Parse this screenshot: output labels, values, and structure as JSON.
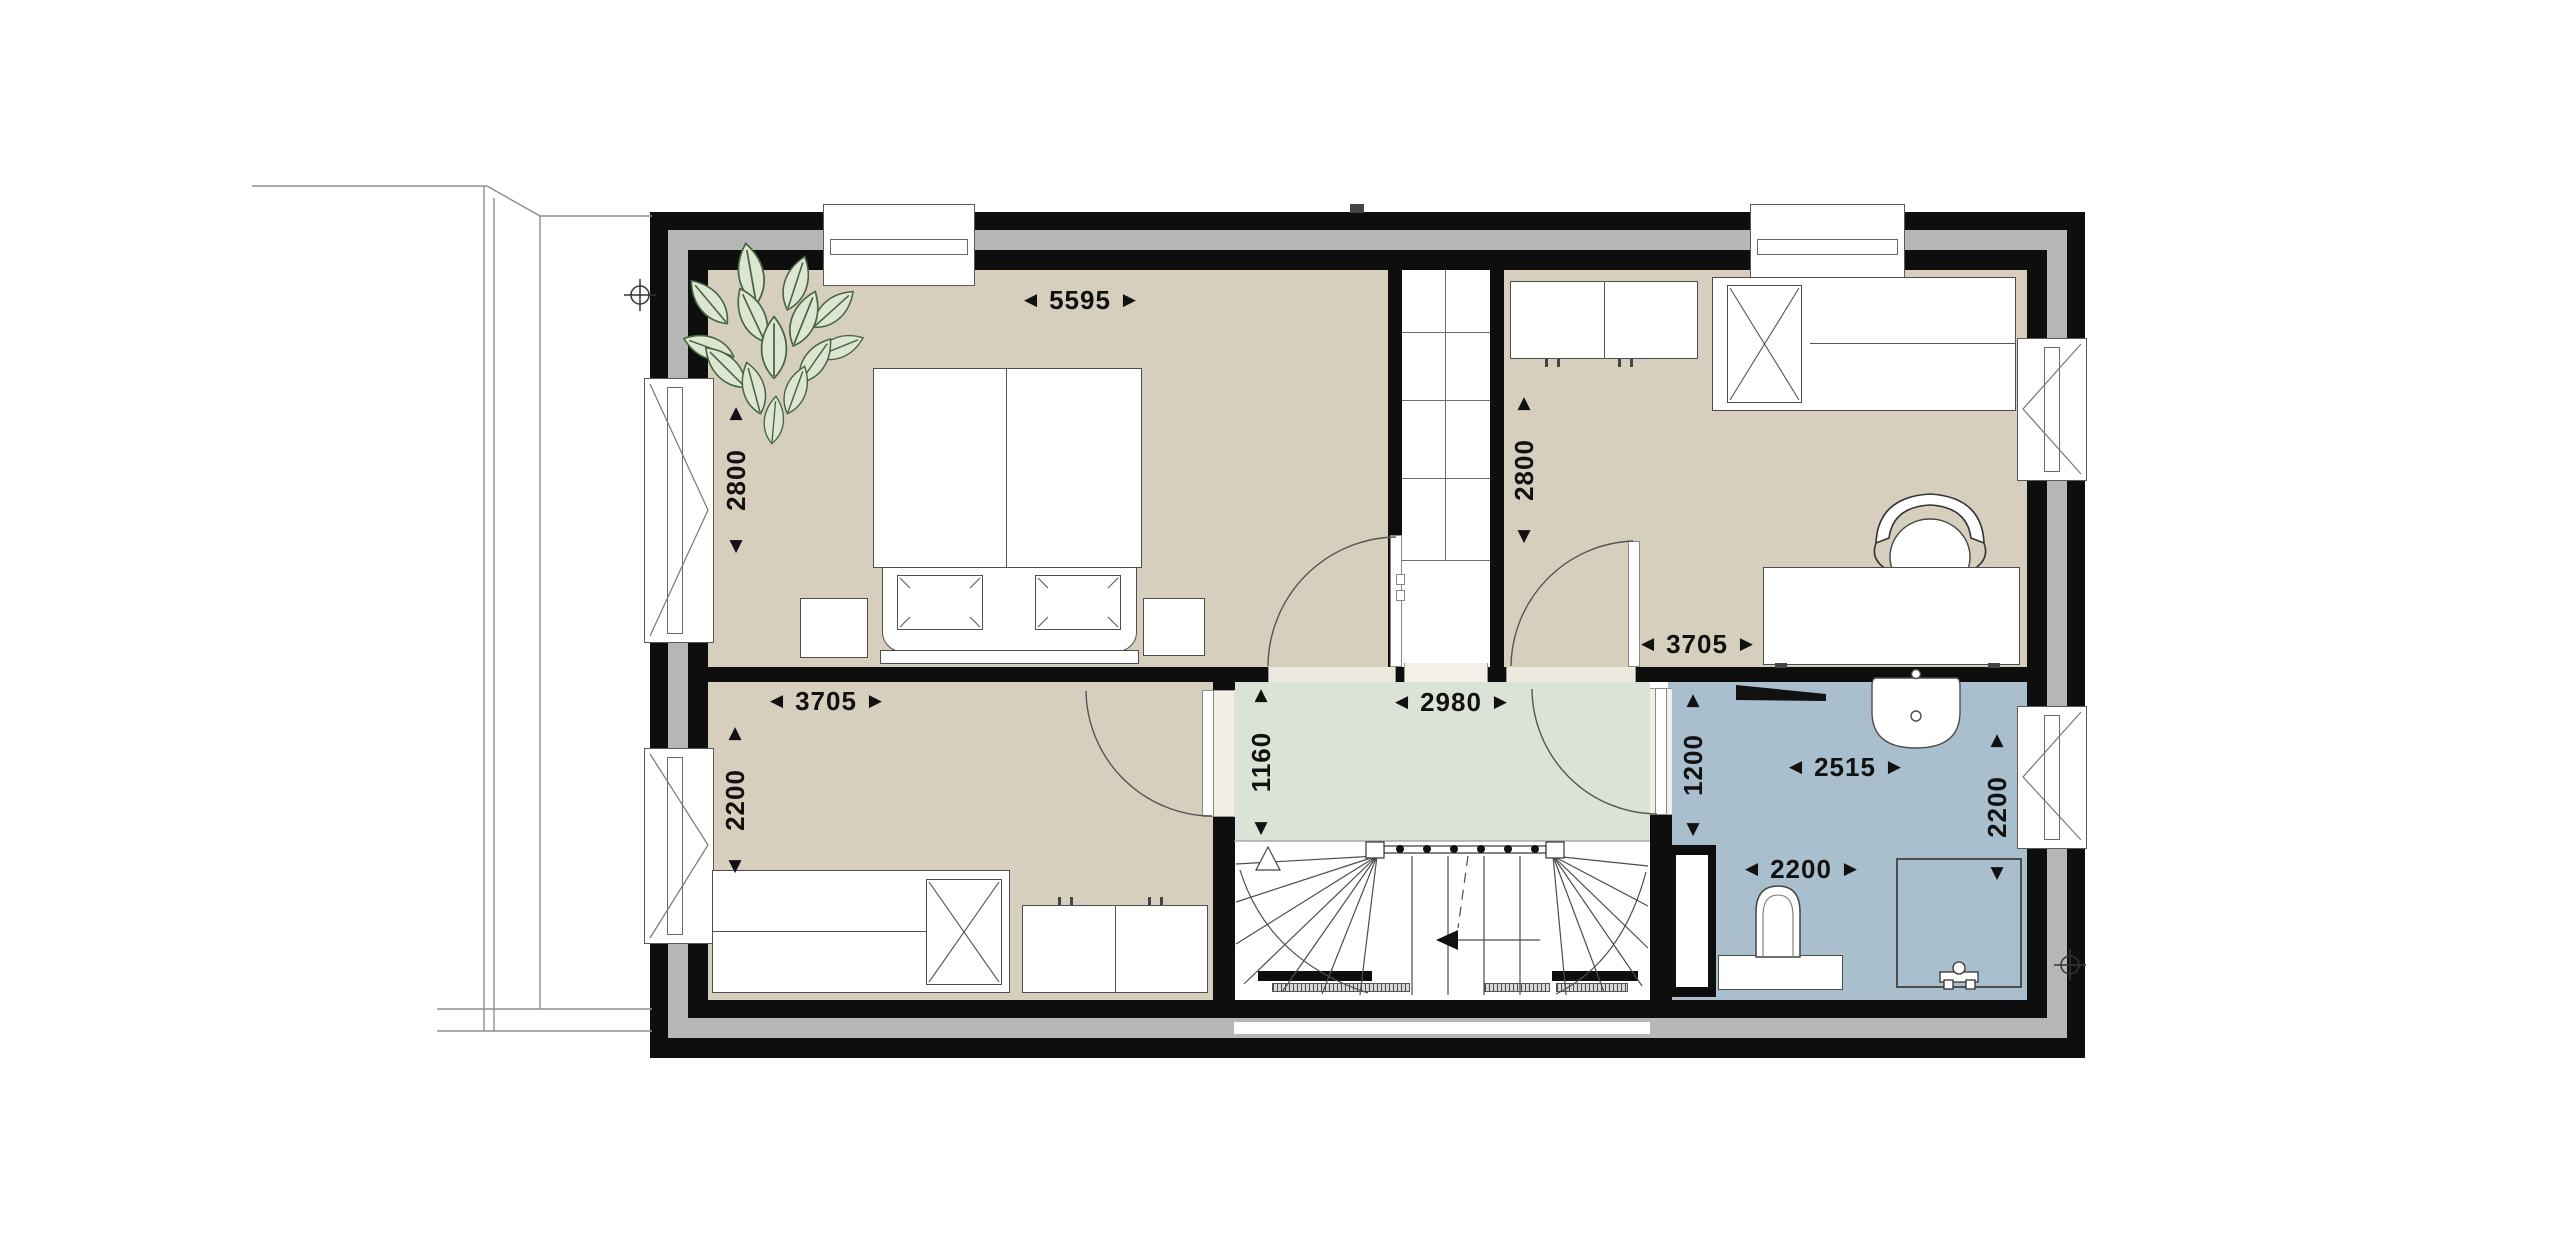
{
  "icons": {
    "arrow_left": "◀",
    "arrow_right": "▶",
    "arrow_up": "▲",
    "arrow_down": "▼"
  },
  "colors": {
    "wall": "#0e0e0e",
    "insulation": "#b6b6b6",
    "bedroom_floor": "#d7cfbe",
    "hallway_floor": "#dbe2d6",
    "bathroom_floor": "#a9bfcd",
    "background": "#ffffff",
    "plant_leaf_fill": "#dce6d2",
    "plant_leaf_stroke": "#47663f"
  },
  "dimensions": {
    "master_bedroom": {
      "width": "5595",
      "height": "2800"
    },
    "bedroom_top_right": {
      "width": "3705",
      "height": "2800"
    },
    "bedroom_bottom_left": {
      "width": "3705",
      "height": "2200"
    },
    "hallway": {
      "width": "2980",
      "height": "1160"
    },
    "bathroom": {
      "upper_width": "2515",
      "left_height": "1200",
      "right_height": "2200",
      "lower_width": "2200"
    }
  }
}
